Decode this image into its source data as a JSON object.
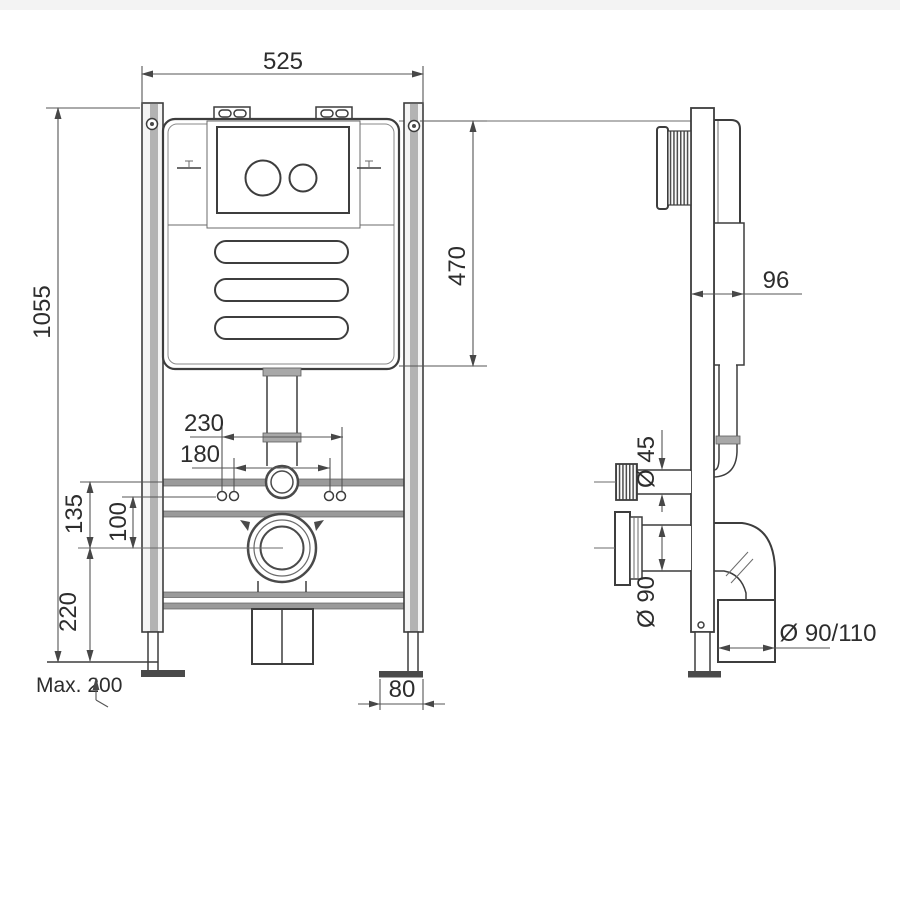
{
  "dimensions": {
    "width": "525",
    "height": "1055",
    "tank_height": "470",
    "bolt_spacing_outer": "230",
    "bolt_spacing_inner": "180",
    "bend_to_outlet": "135",
    "bolts_to_outlet": "100",
    "outlet_to_floor": "220",
    "leg_adjustment": "Max. 200",
    "foot_plate_width": "80",
    "depth": "96",
    "flush_pipe_diameter": "Ø 45",
    "outlet_diameter": "Ø 90",
    "drain_pipe_diameter": "Ø 90/110"
  }
}
